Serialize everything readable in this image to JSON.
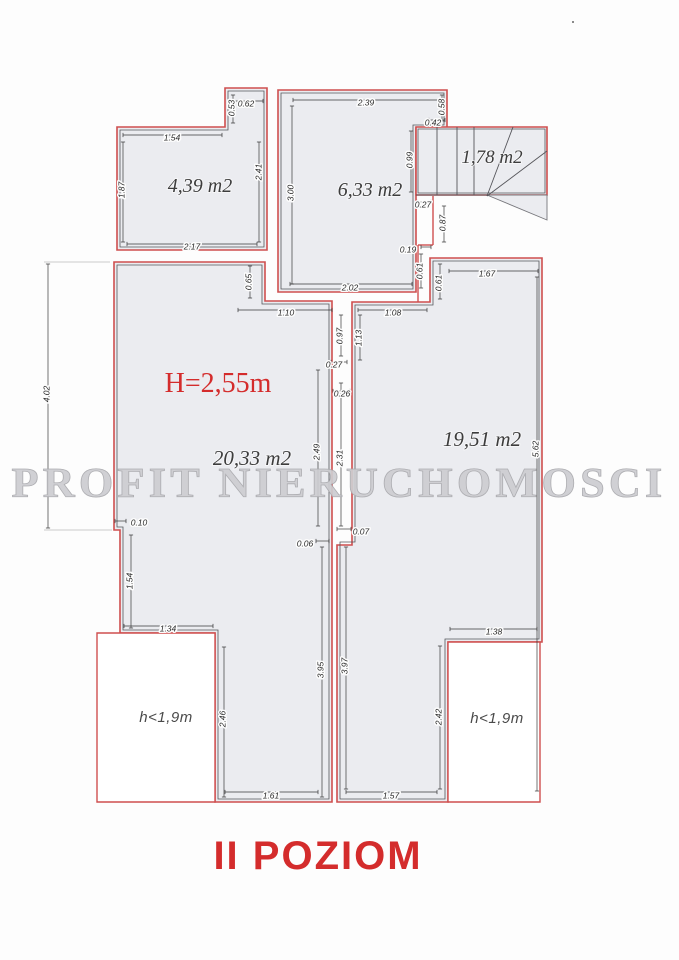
{
  "title": "II POZIOM",
  "watermark": "PROFIT NIERUCHOMOSCI",
  "colors": {
    "line_red": "#cf4f4f",
    "fill_gray": "#ebecf0",
    "text_red": "#d42c2c",
    "watermark_gray": "#cdcdd1"
  },
  "rooms": [
    {
      "name": "room-top-left",
      "area_label": "4,39 m2"
    },
    {
      "name": "room-top-mid",
      "area_label": "6,33 m2"
    },
    {
      "name": "staircase",
      "area_label": "1,78 m2"
    },
    {
      "name": "room-main-left",
      "area_label": "20,33 m2",
      "height_label": "H=2,55m"
    },
    {
      "name": "room-main-right",
      "area_label": "19,51 m2"
    },
    {
      "name": "attic-left",
      "area_label": "h<1,9m"
    },
    {
      "name": "attic-right",
      "area_label": "h<1,9m"
    }
  ],
  "dims": [
    {
      "v": "0.62",
      "x": 246,
      "y": 104,
      "r": 0
    },
    {
      "v": "0.53",
      "x": 232,
      "y": 108,
      "r": -90
    },
    {
      "v": "1.54",
      "x": 172,
      "y": 138,
      "r": 0
    },
    {
      "v": "1.87",
      "x": 122,
      "y": 190,
      "r": -90
    },
    {
      "v": "2.41",
      "x": 259,
      "y": 172,
      "r": -90
    },
    {
      "v": "2.17",
      "x": 192,
      "y": 247,
      "r": 0
    },
    {
      "v": "2.39",
      "x": 366,
      "y": 103,
      "r": 0
    },
    {
      "v": "3.00",
      "x": 291,
      "y": 193,
      "r": -90
    },
    {
      "v": "0.58",
      "x": 442,
      "y": 107,
      "r": -90
    },
    {
      "v": "0.42",
      "x": 433,
      "y": 123,
      "r": 0
    },
    {
      "v": "0.99",
      "x": 410,
      "y": 160,
      "r": -90
    },
    {
      "v": "0.27",
      "x": 423,
      "y": 205,
      "r": 0
    },
    {
      "v": "0.87",
      "x": 443,
      "y": 223,
      "r": -90
    },
    {
      "v": "0.19",
      "x": 408,
      "y": 250,
      "r": 0
    },
    {
      "v": "0.61",
      "x": 420,
      "y": 271,
      "r": -90
    },
    {
      "v": "2.02",
      "x": 350,
      "y": 288,
      "r": 0
    },
    {
      "v": "0.61",
      "x": 439,
      "y": 283,
      "r": -90
    },
    {
      "v": "1.67",
      "x": 487,
      "y": 274,
      "r": 0
    },
    {
      "v": "5.62",
      "x": 536,
      "y": 449,
      "r": -90
    },
    {
      "v": "0.65",
      "x": 249,
      "y": 282,
      "r": -90
    },
    {
      "v": "1.10",
      "x": 286,
      "y": 313,
      "r": 0
    },
    {
      "v": "1.08",
      "x": 393,
      "y": 313,
      "r": 0
    },
    {
      "v": "0.97",
      "x": 340,
      "y": 336,
      "r": -90
    },
    {
      "v": "1.13",
      "x": 359,
      "y": 338,
      "r": -90
    },
    {
      "v": "0.27",
      "x": 334,
      "y": 365,
      "r": 0
    },
    {
      "v": "0.26",
      "x": 342,
      "y": 394,
      "r": 0
    },
    {
      "v": "2.49",
      "x": 317,
      "y": 452,
      "r": -90
    },
    {
      "v": "2.31",
      "x": 340,
      "y": 458,
      "r": -90
    },
    {
      "v": "0.07",
      "x": 361,
      "y": 532,
      "r": 0
    },
    {
      "v": "0.06",
      "x": 305,
      "y": 544,
      "r": 0
    },
    {
      "v": "4.02",
      "x": 47,
      "y": 394,
      "r": -90
    },
    {
      "v": "0.10",
      "x": 139,
      "y": 523,
      "r": 0
    },
    {
      "v": "1.54",
      "x": 130,
      "y": 581,
      "r": -90
    },
    {
      "v": "1.34",
      "x": 168,
      "y": 629,
      "r": 0
    },
    {
      "v": "2.46",
      "x": 223,
      "y": 719,
      "r": -90
    },
    {
      "v": "3.95",
      "x": 321,
      "y": 670,
      "r": -90
    },
    {
      "v": "1.61",
      "x": 271,
      "y": 796,
      "r": 0
    },
    {
      "v": "3.97",
      "x": 345,
      "y": 666,
      "r": -90
    },
    {
      "v": "1.38",
      "x": 494,
      "y": 632,
      "r": 0
    },
    {
      "v": "2.42",
      "x": 439,
      "y": 717,
      "r": -90
    },
    {
      "v": "1.57",
      "x": 391,
      "y": 796,
      "r": 0
    }
  ]
}
